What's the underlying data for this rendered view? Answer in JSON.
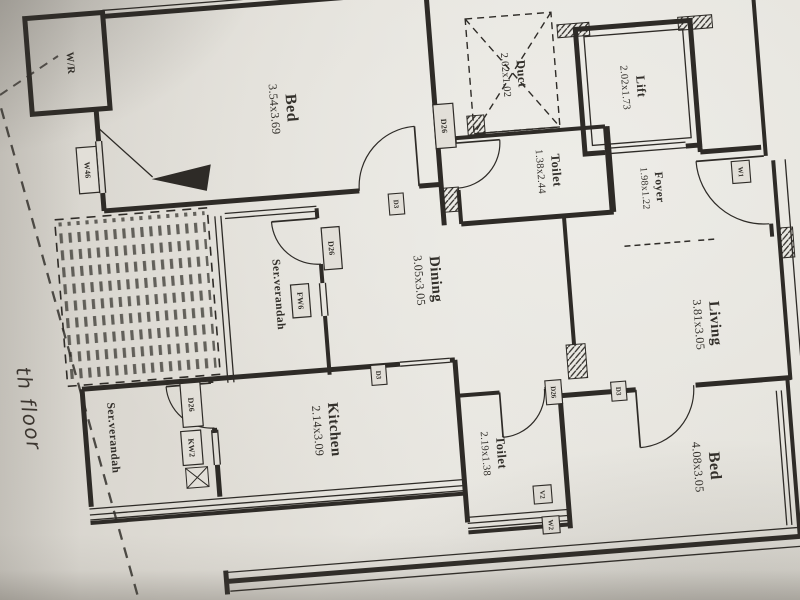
{
  "photo": {
    "description": "photograph of an architect floor plan, plan rotated 90 degrees clockwise",
    "paper_color": "#e2dfd8",
    "ink_color": "#2e2b27",
    "handwritten_note": "th floor"
  },
  "rooms": [
    {
      "name": "W/R",
      "dims": ""
    },
    {
      "name": "Bed",
      "dims": "3.54x3.69"
    },
    {
      "name": "Duct",
      "dims": "2.02x1.02"
    },
    {
      "name": "Lift",
      "dims": "2.02x1.73"
    },
    {
      "name": "Toilet",
      "dims": "1.38x2.44"
    },
    {
      "name": "Foyer",
      "dims": "1.98x1.22"
    },
    {
      "name": "Dining",
      "dims": "3.05x3.05"
    },
    {
      "name": "Living",
      "dims": "3.81x3.05"
    },
    {
      "name": "Ser.verandah",
      "dims": ""
    },
    {
      "name": "Ser.verandah",
      "dims": ""
    },
    {
      "name": "Kitchen",
      "dims": "2.14x3.09"
    },
    {
      "name": "Toilet",
      "dims": "2.19x1.38"
    },
    {
      "name": "Bed",
      "dims": "4.08x3.05"
    }
  ],
  "tags": {
    "w46": "W46",
    "d26": "D26",
    "d3": "D3",
    "fw6": "FW6",
    "kw2": "KW2",
    "v2": "V2",
    "w2": "W2",
    "w1": "W1"
  }
}
